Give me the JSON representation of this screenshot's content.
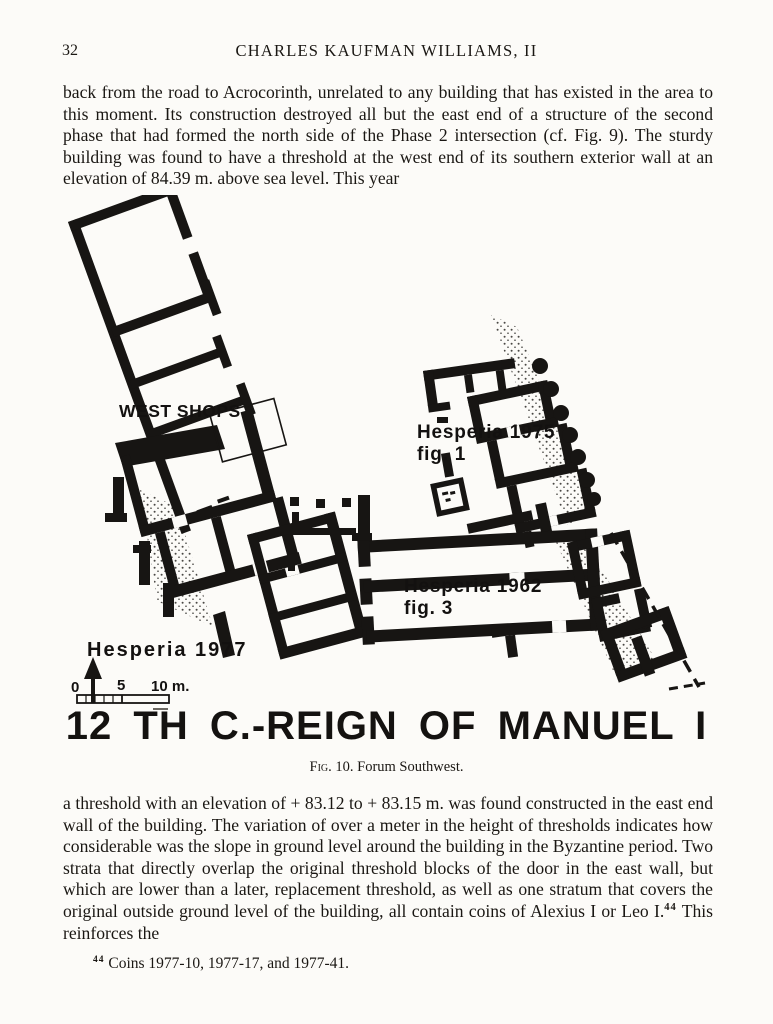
{
  "page": {
    "number": "32",
    "running_head": "CHARLES KAUFMAN WILLIAMS, II"
  },
  "body": {
    "paragraph_top": "back from the road to Acrocorinth, unrelated to any building that has existed in the area to this moment.  Its construction destroyed all but the east end of a structure of the second phase that had formed the north side of the Phase 2 intersection (cf. Fig. 9).  The sturdy building was found to have a threshold at the west end of its southern exterior wall at an elevation of 84.39 m. above sea level.  This year",
    "paragraph_bottom_before_note": "a threshold with an elevation of + 83.12 to + 83.15 m. was found constructed in the east end wall of the building.  The variation of over a meter in the height of thresholds indicates how considerable was the slope in ground level around the building in the Byzantine period.  Two strata that directly overlap the original threshold blocks of the door in the east wall, but which are lower than a later, replacement threshold, as well as one stratum that covers the original outside ground level of the building, all contain coins of Alexius I or Leo I.",
    "note_ref": "44",
    "paragraph_bottom_after_note": "  This reinforces the"
  },
  "figure": {
    "labels": {
      "west_shops": "WEST SHOPS",
      "hesperia_1975_line1": "Hesperia 1975",
      "hesperia_1975_line2": "fig. 1",
      "hesperia_1962_line1": "Hesperia 1962",
      "hesperia_1962_line2": "fig. 3",
      "hesperia_1977": "Hesperia 1977"
    },
    "scale": {
      "zero": "0",
      "five": "5",
      "ten": "10 m."
    },
    "title": "12 TH C.-REIGN OF MANUEL I",
    "caption_label": "Fig. 10.",
    "caption_text": "Forum Southwest."
  },
  "footnote": {
    "ref": "44",
    "text": "Coins 1977-10, 1977-17, and 1977-41."
  },
  "colors": {
    "ink": "#171513",
    "paper": "#fcfbf8"
  }
}
